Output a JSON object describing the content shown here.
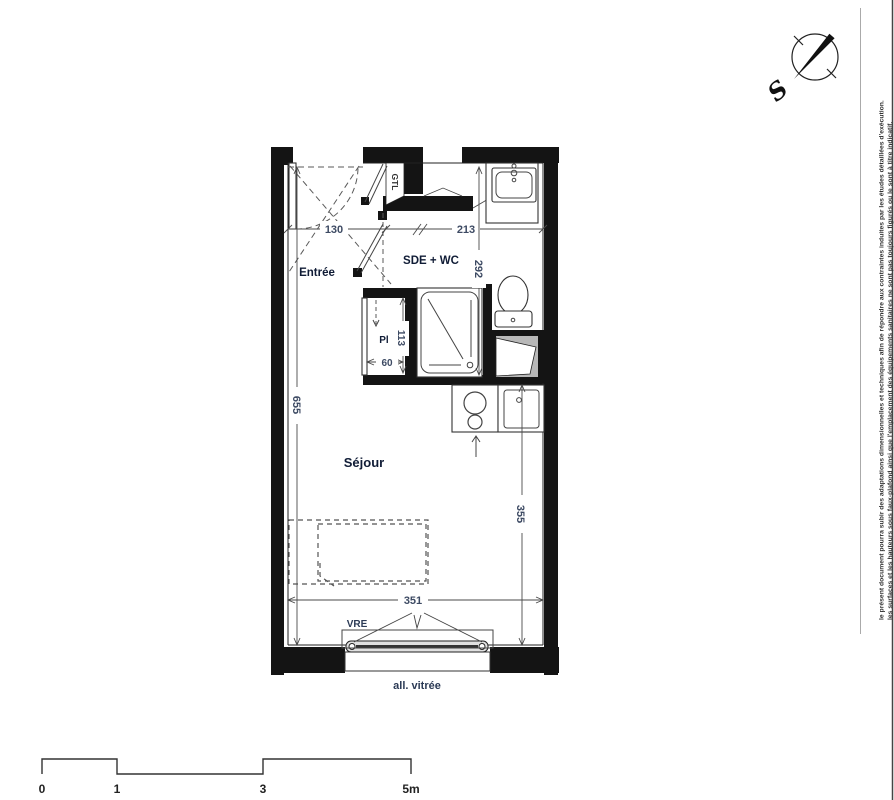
{
  "plan": {
    "room_labels": {
      "entree": "Entrée",
      "sde_wc": "SDE + WC",
      "pl": "Pl",
      "sejour": "Séjour"
    },
    "annotations": {
      "gtl": "GTL",
      "vre": "VRE",
      "all_vitree": "all. vitrée"
    },
    "dimensions_cm": {
      "entree_width": "130",
      "sde_width": "213",
      "sde_depth": "292",
      "pl_depth": "113",
      "pl_width": "60",
      "interior_height": "655",
      "sejour_depth": "355",
      "interior_width": "351"
    }
  },
  "compass": {
    "south_label": "S"
  },
  "disclaimer": {
    "line1": "le présent document pourra subir des adaptations dimensionnelles et techniques afin de répondre aux contraintes induites par les études détaillées d'exécution.",
    "line2": "les surfaces et les hauteurs sous faux-plafond ainsi que l'emplacement des équipements sanitaires ne sont pas toujours figurés ou le sont à titre indicatif."
  },
  "scale_bar": {
    "tick0": "0",
    "tick1": "1",
    "tick3": "3",
    "tick5": "5m"
  },
  "colors": {
    "wall": "#141414",
    "room_label": "#101c36",
    "dimension_text": "#3d4a63",
    "line": "#222222",
    "shaft_gray": "#b8b8b8"
  }
}
